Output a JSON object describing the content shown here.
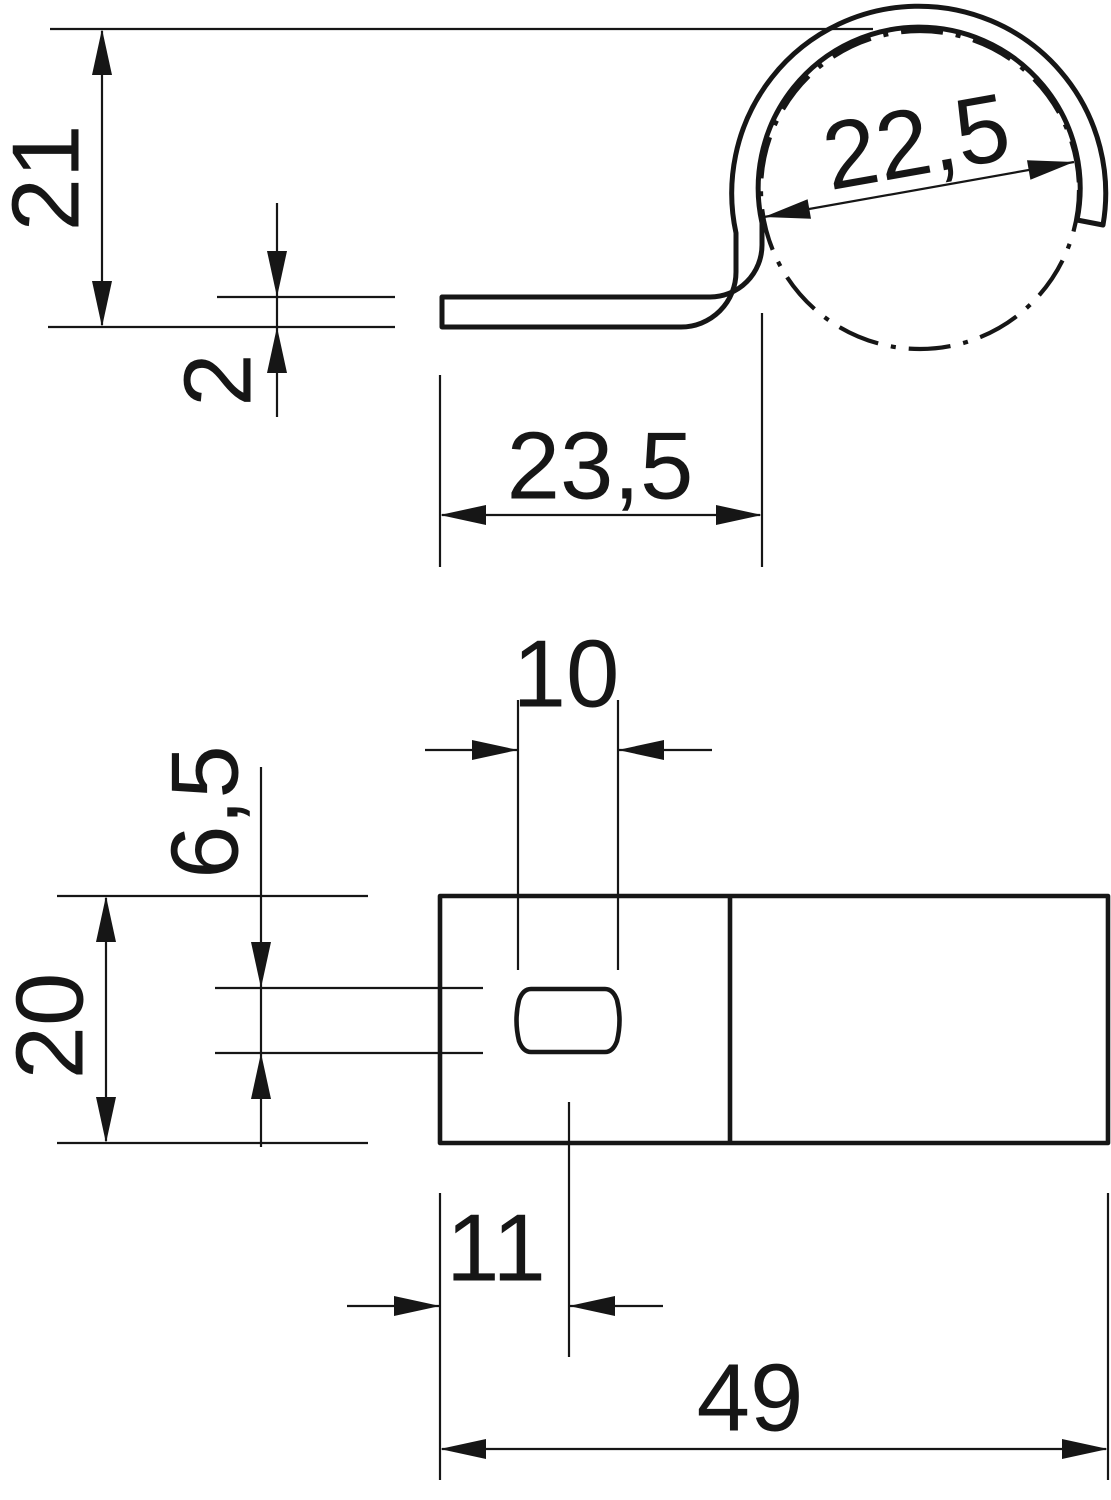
{
  "palette": {
    "ink": "#161616",
    "paper": "#ffffff"
  },
  "side_view": {
    "overall_height": "21",
    "material_thickness": "2",
    "base_length": "23,5",
    "clamping_diameter": "22,5"
  },
  "plan_view": {
    "slot_length": "10",
    "slot_width": "6,5",
    "strap_width": "20",
    "slot_center_from_end": "11",
    "overall_length": "49"
  }
}
